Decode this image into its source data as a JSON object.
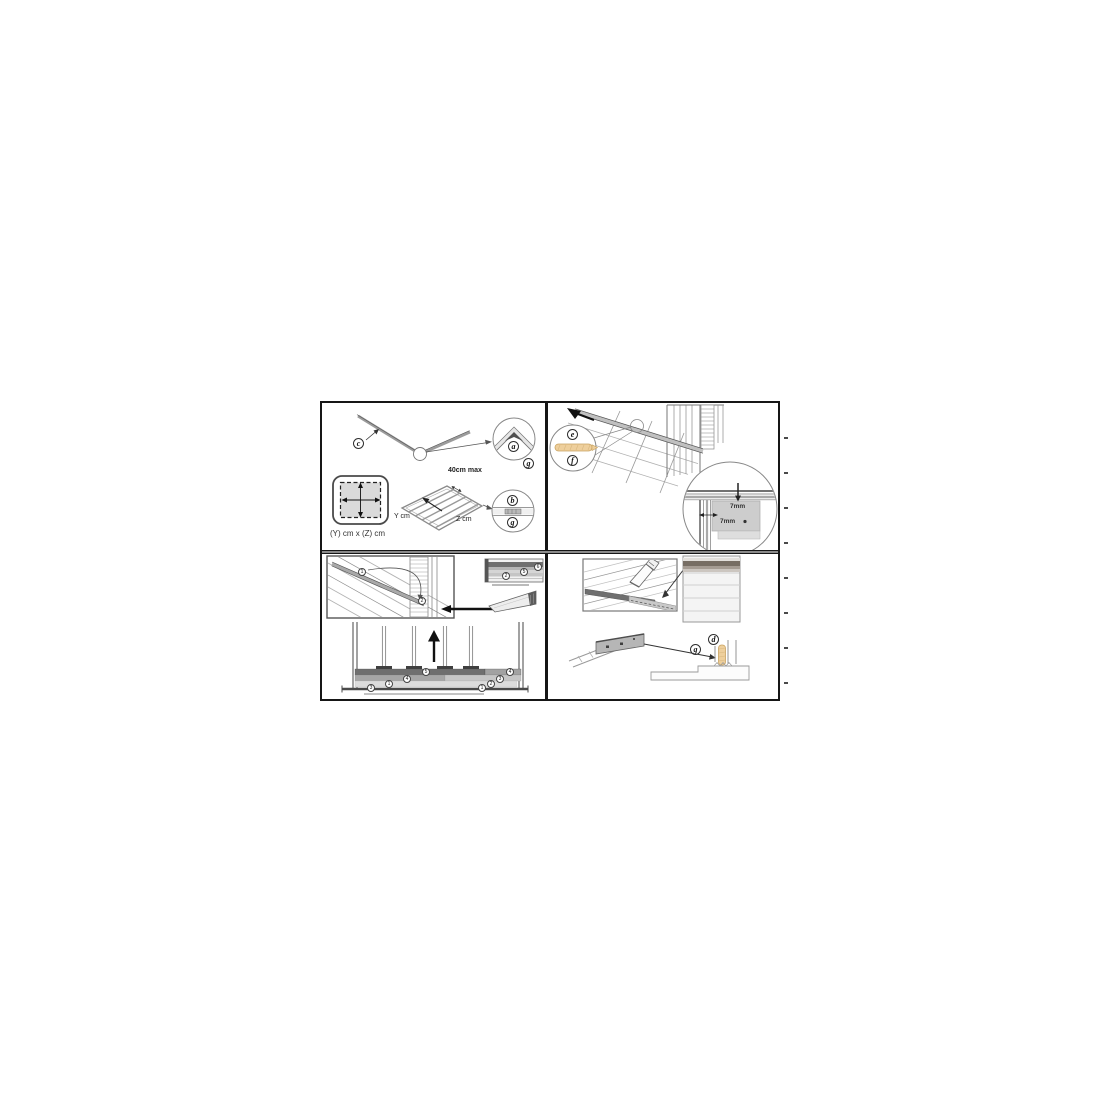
{
  "figure": {
    "description": "Assembly instruction sheet, 4 diagram panels",
    "colors": {
      "accent_tan": "#eecf9c",
      "line_dark": "#161616",
      "fill_gray": "#cdcdcd"
    },
    "panel_top_left": {
      "callout_c": "c",
      "callout_a": "a",
      "callout_g1": "g",
      "callout_b": "b",
      "callout_g2": "g",
      "max_spacing_note": "40cm max",
      "y_axis_label": "Y cm",
      "z_axis_label": "Z cm",
      "footprint_label": "(Y) cm x (Z) cm"
    },
    "panel_top_right": {
      "callout_e": "e",
      "callout_f": "f",
      "gap_top": "7mm",
      "gap_side": "7mm"
    },
    "panel_bottom_left": {
      "batten_step_1": "1",
      "batten_step_2": "2",
      "detail_step_2": "2",
      "detail_step_5": "5",
      "detail_step_6": "6",
      "layer_top": "5",
      "layer_left_4": "4",
      "layer_left_1": "1",
      "layer_left_3": "3",
      "layer_right_4": "4",
      "layer_right_3": "3",
      "layer_right_2": "2",
      "layer_right_1": "1"
    },
    "panel_bottom_right": {
      "callout_g": "g",
      "callout_d": "d"
    }
  }
}
